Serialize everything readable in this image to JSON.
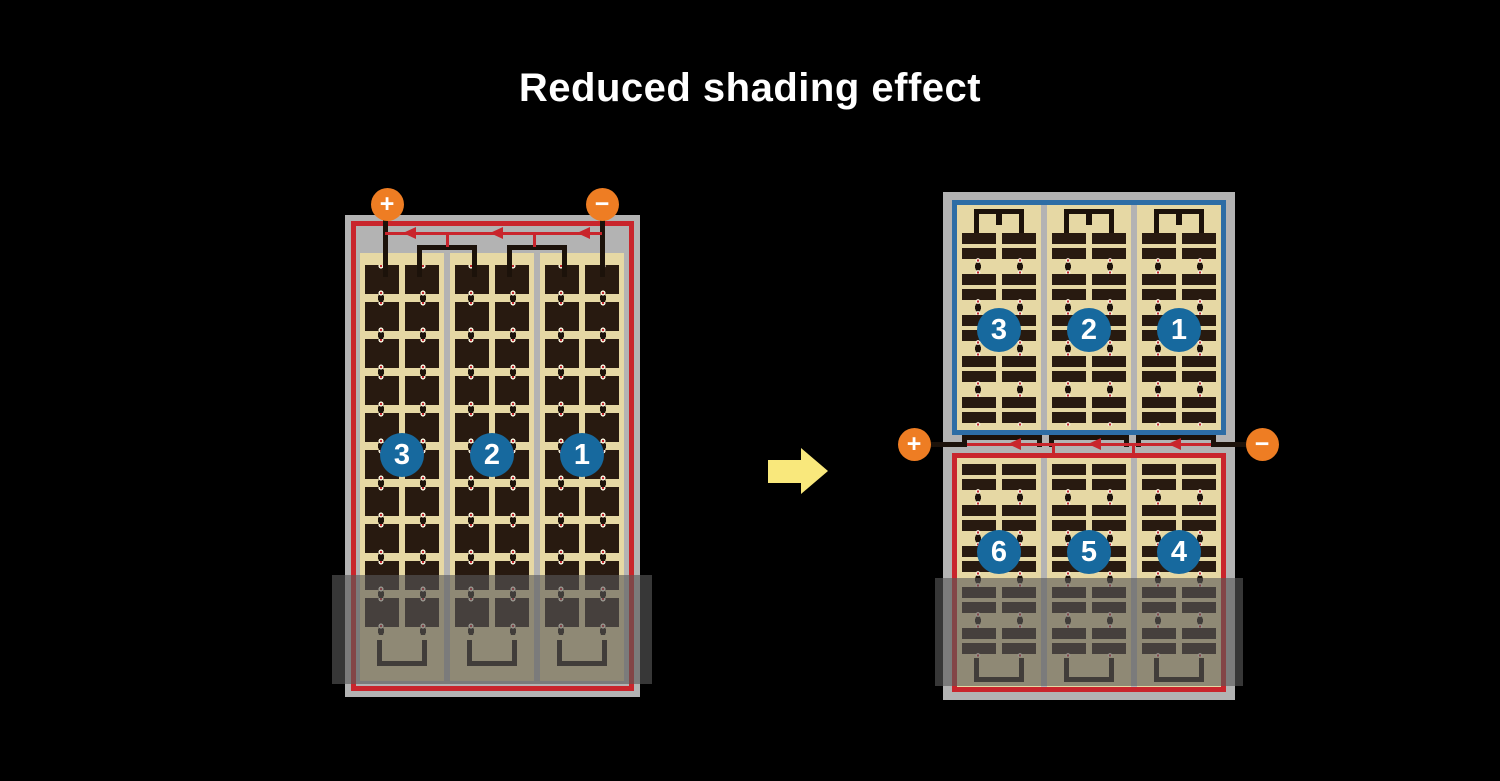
{
  "title": "Reduced shading effect",
  "left_panel": {
    "terminals": {
      "positive": "+",
      "negative": "−"
    },
    "string_labels": [
      "3",
      "2",
      "1"
    ]
  },
  "right_panel": {
    "terminals": {
      "positive": "+",
      "negative": "−"
    },
    "top_string_labels": [
      "3",
      "2",
      "1"
    ],
    "bottom_string_labels": [
      "6",
      "5",
      "4"
    ]
  },
  "icons": {
    "flow_arrow": "right-arrow",
    "bypass_diode": "left-pointing-diode-arrow"
  },
  "colors": {
    "background": "#000000",
    "title_text": "#ffffff",
    "frame_gray": "#b3b3b3",
    "cell_dark": "#281a10",
    "cell_background_tan": "#e6d8a4",
    "circuit_red": "#c9252c",
    "circuit_blue": "#2d6da5",
    "number_circle_blue": "#17699e",
    "terminal_orange": "#ee7d23",
    "flow_arrow_yellow": "#f9e87c",
    "shade_overlay": "rgba(88,88,88,0.62)"
  }
}
